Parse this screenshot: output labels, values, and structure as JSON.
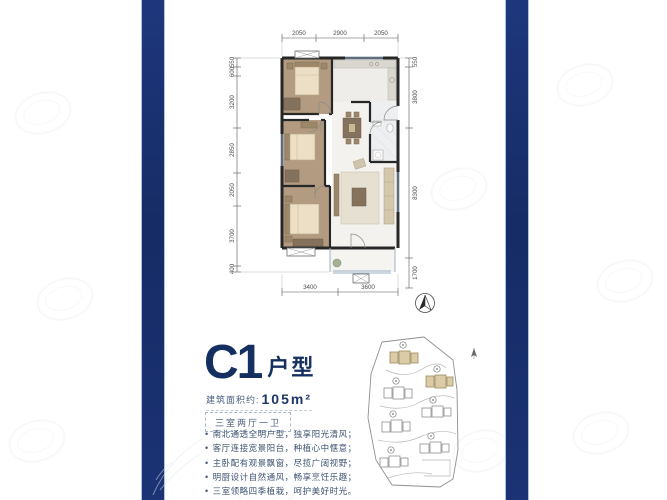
{
  "colors": {
    "navy_band": "#1b3274",
    "title_navy": "#152f60",
    "bedroom_tan": "#b29b80",
    "wall_dark": "#272727"
  },
  "plan": {
    "dims_top": [
      "2050",
      "2900",
      "2050"
    ],
    "dims_left": [
      "550",
      "600",
      "3200",
      "2850",
      "2050",
      "3700",
      "400"
    ],
    "dims_right": [
      "550",
      "3800",
      "8300",
      "1700"
    ],
    "dims_bottom": [
      "3400",
      "3600"
    ]
  },
  "unit": {
    "code": "C1",
    "type_label": "户型",
    "area_label": "建筑面积约:",
    "area_value": "105m²",
    "rooms_tag": "三室两厅一卫"
  },
  "features": [
    "南北通透全明户型，独享阳光清风；",
    "客厅连接宽景阳台，种植心中惬意；",
    "主卧配有观景飘窗，尽揽广阔视野；",
    "明厨设计自然通风，畅享烹饪乐趣；",
    "三室领略四季植栽，呵护美好时光。"
  ]
}
